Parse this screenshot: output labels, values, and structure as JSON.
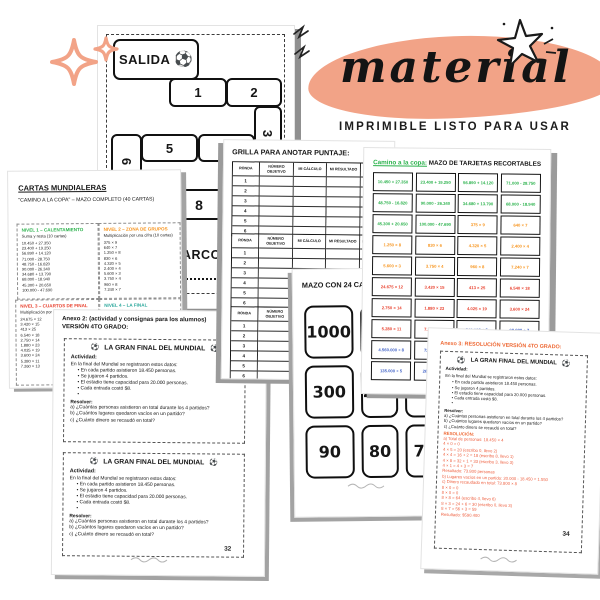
{
  "hero": {
    "title": "material",
    "subtitle": "IMPRIMIBLE LISTO PARA USAR",
    "blob_color": "#f2a387",
    "sparkle_color": "#f2a387"
  },
  "icons": {
    "ball": "⚽"
  },
  "board": {
    "salida": "SALIDA",
    "arco": "ARCO",
    "cells": [
      "1",
      "2",
      "3",
      "5",
      "4",
      "6",
      "8"
    ]
  },
  "cartas": {
    "title": "CARTAS MUNDIALERAS",
    "subtitle": "\"CAMINO A LA COPA\" – MAZO COMPLETO (40 CARTAS)",
    "levels": [
      {
        "name": "NIVEL 1 – CALENTAMIENTO",
        "color": "#2bb24c",
        "desc": "Suma y resta (10 cartas)",
        "items": [
          "10.450 + 27.350",
          "23.400 + 19.250",
          "56.890 + 14.120",
          "71.000 - 28.750",
          "48.750 - 16.820",
          "90.000 - 26.340",
          "34.680 + 13.790",
          "68.000 - 18.940",
          "45.300 + 20.650",
          "100.000 - 47.690"
        ]
      },
      {
        "name": "NIVEL 2 – ZONA DE GRUPOS",
        "color": "#f7941d",
        "desc": "Multiplicación por una cifra (10 cartas)",
        "items": [
          "375 × 9",
          "640 × 7",
          "1.250 × 8",
          "830 × 6",
          "4.320 × 5",
          "2.400 × 4",
          "5.600 × 3",
          "3.750 × 4",
          "960 × 8",
          "7.240 × 7"
        ]
      },
      {
        "name": "NIVEL 3 – CUARTOS DE FINAL",
        "color": "#e8402d",
        "desc": "Multiplicación por dos cifras (10 cartas)",
        "items": [
          "24.675 × 12",
          "3.420 × 15",
          "413 × 25",
          "6.540 × 18",
          "2.750 × 14",
          "1.880 × 23",
          "4.025 × 19",
          "3.600 × 24",
          "5.280 × 11",
          "7.260 × 13"
        ]
      },
      {
        "name": "NIVEL 4 – LA FINAL",
        "color": "#2aa79b",
        "desc": "División (5 cartas)",
        "items": [
          "540.000 ÷ 6",
          "98.000 ÷ 7",
          "4.560.000 ÷ 8",
          "72.600 ÷ 9",
          "135.000 ÷ 5"
        ]
      }
    ]
  },
  "grilla": {
    "title": "GRILLA PARA ANOTAR PUNTAJE:",
    "columns": [
      "RONDA",
      "NÚMERO OBJETIVO",
      "MI CÁLCULO",
      "MI RESULTADO",
      "DIFERENCIA"
    ],
    "rondas": [
      "1",
      "2",
      "3",
      "4",
      "5",
      "6"
    ]
  },
  "tarjetas": {
    "title_highlight": "Camino a la copa:",
    "title_rest": "MAZO DE TARJETAS RECORTABLES",
    "colors": {
      "suma_resta": "#2bb24c",
      "mult_una_cifra": "#f7941d",
      "mult_dos_cifras": "#e8402d",
      "division": "#4263c7"
    },
    "cells": [
      {
        "t": "10.450 + 27.350",
        "c": "#2bb24c"
      },
      {
        "t": "23.400 + 19.250",
        "c": "#2bb24c"
      },
      {
        "t": "56.890 + 14.120",
        "c": "#2bb24c"
      },
      {
        "t": "71.000 - 28.750",
        "c": "#2bb24c"
      },
      {
        "t": "48.750 - 16.820",
        "c": "#2bb24c"
      },
      {
        "t": "90.000 - 26.340",
        "c": "#2bb24c"
      },
      {
        "t": "34.680 + 13.790",
        "c": "#2bb24c"
      },
      {
        "t": "68.000 - 18.940",
        "c": "#2bb24c"
      },
      {
        "t": "45.300 + 20.650",
        "c": "#2bb24c"
      },
      {
        "t": "100.000 - 47.690",
        "c": "#2bb24c"
      },
      {
        "t": "375 × 9",
        "c": "#f7941d"
      },
      {
        "t": "640 × 7",
        "c": "#f7941d"
      },
      {
        "t": "1.250 × 8",
        "c": "#f7941d"
      },
      {
        "t": "830 × 6",
        "c": "#f7941d"
      },
      {
        "t": "4.320 × 5",
        "c": "#f7941d"
      },
      {
        "t": "2.400 × 4",
        "c": "#f7941d"
      },
      {
        "t": "5.600 × 3",
        "c": "#f7941d"
      },
      {
        "t": "3.750 × 4",
        "c": "#f7941d"
      },
      {
        "t": "960 × 8",
        "c": "#f7941d"
      },
      {
        "t": "7.240 × 7",
        "c": "#f7941d"
      },
      {
        "t": "24.675 × 12",
        "c": "#e8402d"
      },
      {
        "t": "3.420 × 15",
        "c": "#e8402d"
      },
      {
        "t": "413 × 25",
        "c": "#e8402d"
      },
      {
        "t": "6.540 × 18",
        "c": "#e8402d"
      },
      {
        "t": "2.750 × 14",
        "c": "#e8402d"
      },
      {
        "t": "1.880 × 23",
        "c": "#e8402d"
      },
      {
        "t": "4.025 × 19",
        "c": "#e8402d"
      },
      {
        "t": "3.600 × 24",
        "c": "#e8402d"
      },
      {
        "t": "5.280 × 11",
        "c": "#e8402d"
      },
      {
        "t": "7.260 × 13",
        "c": "#e8402d"
      },
      {
        "t": "540.000 ÷ 6",
        "c": "#4263c7"
      },
      {
        "t": "98.000 ÷ 7",
        "c": "#4263c7"
      },
      {
        "t": "4.560.000 ÷ 8",
        "c": "#4263c7"
      },
      {
        "t": "72.600 ÷ 9",
        "c": "#4263c7"
      },
      {
        "t": "560.000 ÷ 10",
        "c": "#4263c7"
      },
      {
        "t": "84.000 ÷ 6",
        "c": "#4263c7"
      },
      {
        "t": "135.000 ÷ 5",
        "c": "#4263c7"
      },
      {
        "t": "264.000 ÷ 8",
        "c": "#4263c7"
      },
      {
        "t": "",
        "c": "#4263c7"
      },
      {
        "t": "",
        "c": "#4263c7"
      }
    ]
  },
  "mazo": {
    "title": "MAZO CON 24 CARTAS:",
    "cards": [
      "1000",
      "500",
      "",
      "300",
      "200",
      "",
      "90",
      "80",
      "70"
    ]
  },
  "worksheet": {
    "anexo_line1": "Anexo 2: (actividad y consignas para los alumnos)",
    "anexo_line2": "VERSIÓN 4TO GRADO:",
    "box_title": "LA GRAN FINAL DEL MUNDIAL",
    "actividad_label": "Actividad:",
    "intro": "En la final del Mundial se registraron estos datos:",
    "bullets": [
      "En cada partido asistieron 18.450 personas.",
      "Se jugaron 4 partidos.",
      "El estadio tiene capacidad para 20.000 personas.",
      "Cada entrada costó $8.",
      ""
    ],
    "resolver_label": "Resolver:",
    "questions": [
      "a) ¿Cuántas personas asistieron en total durante los 4 partidos?",
      "b) ¿Cuántos lugares quedaron vacíos en un partido?",
      "c) ¿Cuánto dinero se recaudó en total?"
    ],
    "page_number": "32"
  },
  "solucion": {
    "anexo_line": "Anexo 3: RESOLUCIÓN VERSIÓN 4TO GRADO:",
    "resolucion_label": "RESOLUCIÓN:",
    "lines": [
      "a) Total de personas: 18.450 × 4",
      "4 × 0 = 0",
      "4 × 5 = 20 (escribo 0, llevo 2)",
      "4 × 4 = 16 + 2 = 18 (escribo 8, llevo 1)",
      "4 × 8 = 32 + 1 = 33 (escribo 3, llevo 3)",
      "4 × 1 = 4 + 3 = 7",
      "Resultado: 73.800 personas",
      "b) Lugares vacíos en un partido: 20.000 - 18.450 = 1.550",
      "c) Dinero recaudado en total: 73.800 × 8",
      "8 × 0 = 0",
      "8 × 0 = 0",
      "8 × 8 = 64 (escribo 4, llevo 6)",
      "8 × 3 = 24 + 6 = 30 (escribo 0, llevo 3)",
      "8 × 7 = 56 + 3 = 59",
      "Resultado: $590.400"
    ],
    "page_number": "34"
  }
}
